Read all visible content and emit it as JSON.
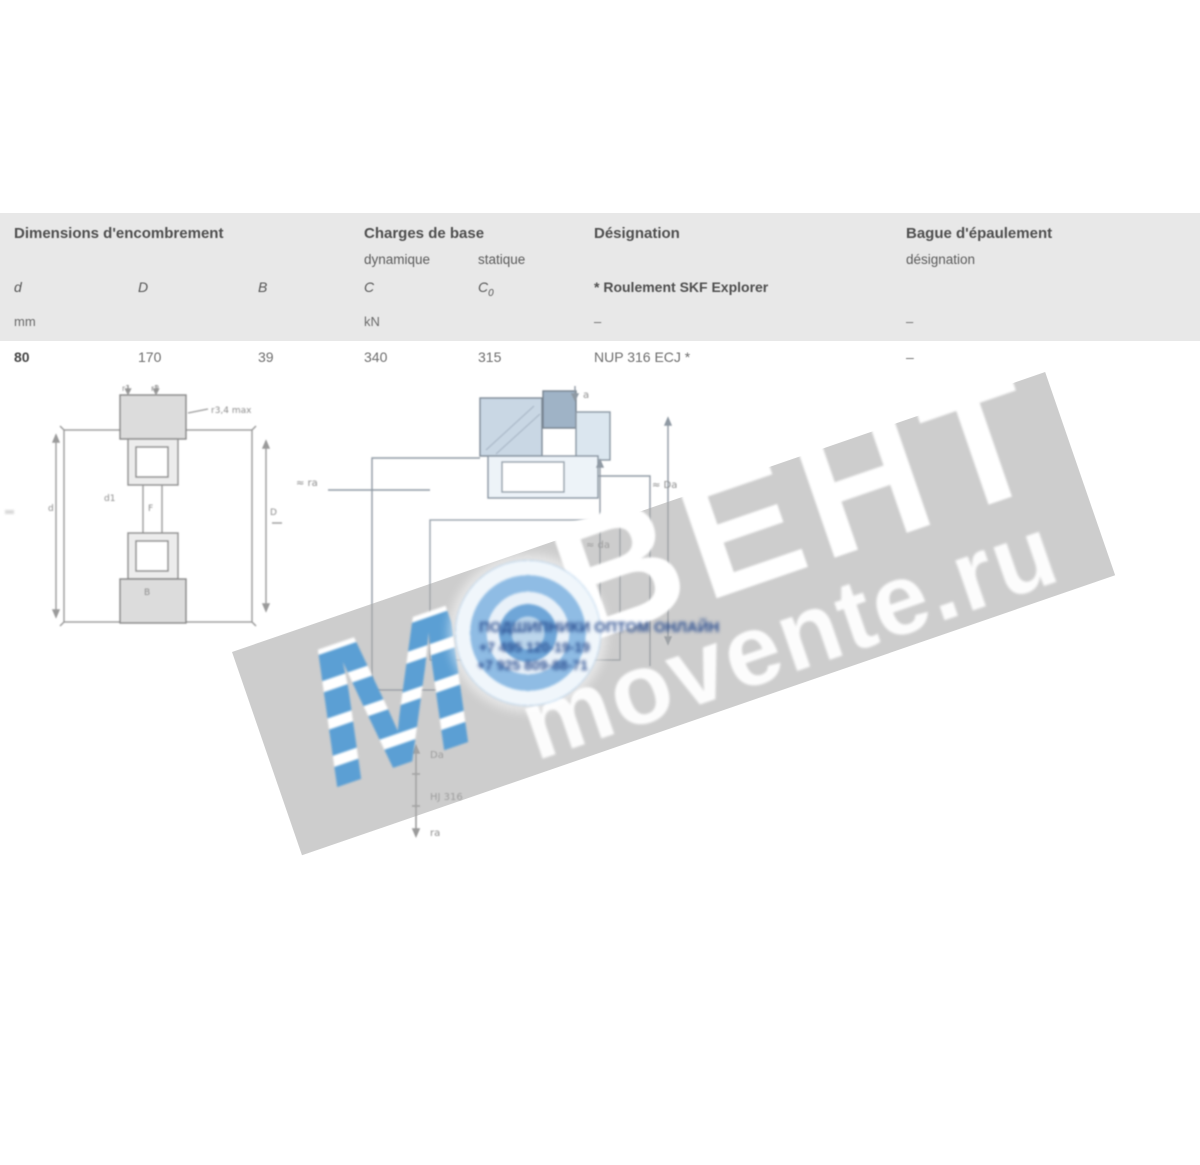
{
  "table": {
    "groups": {
      "dimensions": "Dimensions d'encombrement",
      "loads": "Charges de base",
      "loads_dynamic": "dynamique",
      "loads_static": "statique",
      "designation": "Désignation",
      "designation_note": "* Roulement SKF Explorer",
      "ring": "Bague d'épaulement",
      "ring_sub": "désignation"
    },
    "symbols": {
      "d": "d",
      "D": "D",
      "B": "B",
      "C": "C",
      "C0_base": "C",
      "C0_sub": "0"
    },
    "units": {
      "dimensions": "mm",
      "loads": "kN",
      "designation": "–",
      "ring": "–"
    },
    "row": {
      "d": "80",
      "D": "170",
      "B": "39",
      "C": "340",
      "C0": "315",
      "designation": "NUP 316 ECJ *",
      "ring": "–"
    }
  },
  "watermark": {
    "letter_m": "М",
    "letters_rest": "ВЕНТ",
    "site": "movente.ru",
    "contact_line1": "ПОДШИПНИКИ ОПТОМ ОНЛАЙН",
    "contact_line2": "+7 495 120-19-19",
    "contact_line3": "+7 925 809-88-71",
    "band_gray": "#a8a8a8",
    "accent_blue": "#5b9fd4"
  },
  "figures": {
    "left_drawing": {
      "label_r1": "r1",
      "label_r2": "r2",
      "label_r34": "r3,4 max",
      "label_d1": "d1",
      "label_F": "F",
      "label_B": "B",
      "label_d": "d",
      "label_D": "D"
    },
    "center_drawing": {
      "label_a": "a",
      "label_Da": "≈ Da",
      "label_da": "≈ da",
      "label_ra": "≈ ra"
    },
    "scale_figure": {
      "top": "Da",
      "mid": "HJ 316",
      "bottom": "ra"
    }
  }
}
